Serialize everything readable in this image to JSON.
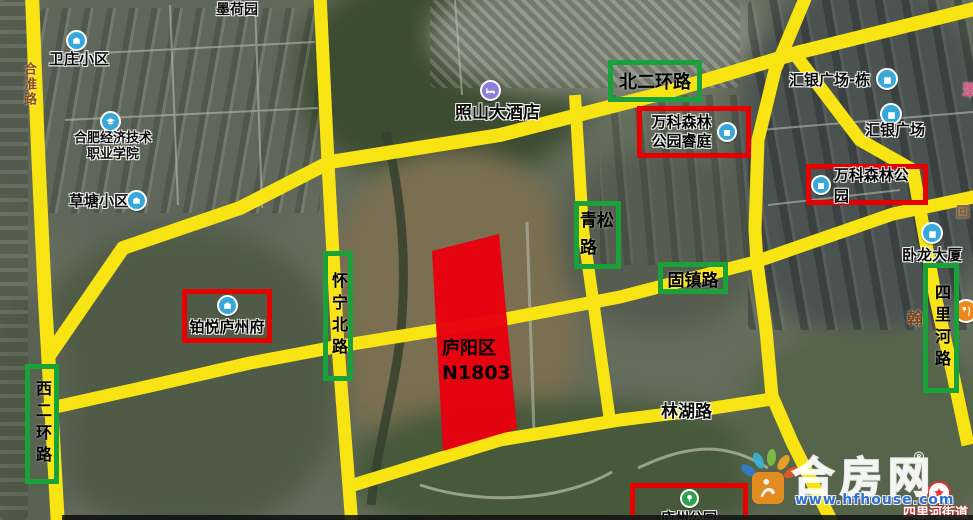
{
  "parcel": {
    "district": "庐阳区",
    "code": "N1803"
  },
  "road_labels": {
    "beierhuanlu": "北二环路",
    "qingsonglu": "青松路",
    "guzhenlu": "固镇路",
    "huainingbeilu": "怀宁北路",
    "xierhuanlu": "西二环路",
    "silihelu": "四里河路",
    "linhulu": "林湖路",
    "hehuailu": "合淮路"
  },
  "red_pois": {
    "vanke_ruiting_line1": "万科森林",
    "vanke_ruiting_line2": "公园睿庭",
    "vanke_park": "万科森林公园",
    "boyue_luzhoufu": "铂悦庐州府",
    "luzhou_park": "庐州公园"
  },
  "pois": {
    "moheyuan": "墨荷园",
    "weizhuang": "卫庄小区",
    "college_line1": "合肥经济技术",
    "college_line2": "职业学院",
    "caotang": "草塘小区",
    "zhaoshan_hotel": "照山大酒店",
    "huiyin_plaza_dong": "汇银广场-栋",
    "huiyin_plaza": "汇银广场",
    "wolong_tower": "卧龙大厦",
    "han_fragment": "翰",
    "silihe_jiedao": "四里河街道",
    "edge_fragment_top": "翠",
    "edge_fragment_mid": "回"
  },
  "watermark": {
    "brand": "合房网",
    "reg": "®",
    "url": "www.hfhouse.com"
  },
  "colors": {
    "road_yellow": "#f8e412",
    "green_box": "#1aa23a",
    "red_box": "#e60000",
    "parcel_red": "#e8000e",
    "poi_blue": "#38a7d9",
    "hotel_purple": "#8f7fd8",
    "park_green": "#2fa04c",
    "star_red": "#e23333",
    "logo_orange": "#ef8f1c",
    "url_blue": "#2f6fd0"
  }
}
